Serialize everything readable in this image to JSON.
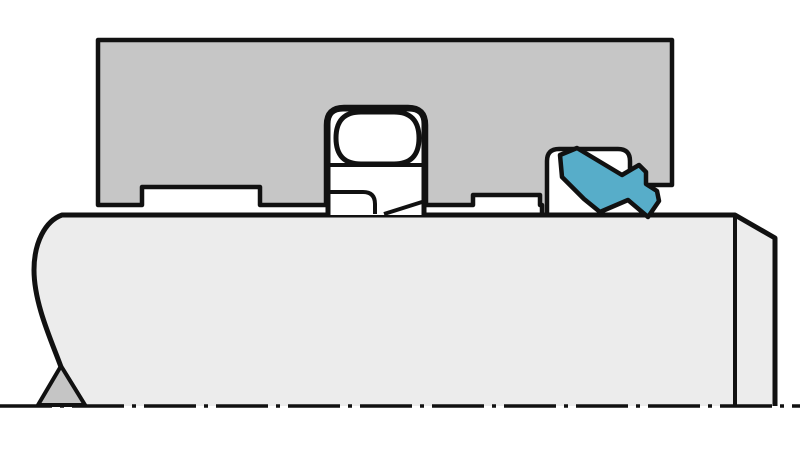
{
  "diagram": {
    "kind": "sectional technical drawing",
    "subject": "rotary shaft sealing arrangement with deep-groove ball bearing and elastomer seal",
    "text_labels": []
  },
  "colors": {
    "background": "#ffffff",
    "housing": "#c6c6c6",
    "shaft": "#ececec",
    "break_cone": "#c5c5c5",
    "seal": "#57adc9",
    "white": "#ffffff",
    "outline": "#111111",
    "none": "none"
  },
  "paths": {
    "housing": "M98,40 L672,40 L672,185 L630,185 L630,161 Q630,149 618,149 L559,149 Q547,149 547,161 L547,215 L542,215 L542,205 L540,205 L540,195 L473,195 L473,205 L426,205 L426,125 Q426,107 408,107 L344,107 Q326,107 326,125 L326,205 L260,205 L260,187 L142,187 L142,205 L98,205 Z",
    "shaft_fill": "M62,215 L735,215 L775,238 L775,406 L85,406 L61,367 C52,342 34,304 34,270 C34,243 45,221 62,215 Z",
    "shaft_stroke": "M85,406 L61,367 C52,342 34,304 34,270 C34,243 45,221 62,215 L735,215 L775,238 L775,406",
    "shaft_step_line": "M735,217 L735,405",
    "break_cone": "M61,366 L38,405 L85,405 Z",
    "bearing_outer": "M328,215 L328,124 Q328,109 343,109 L409,109 Q424,109 424,124 L424,215",
    "bearing_ball": "M361,112 L394,112 Q419,112 419,138 Q419,164 394,164 L361,164 Q336,164 336,138 Q336,112 361,112 Z",
    "bearing_divider": "M330,165 L422,165",
    "bearing_inner_step": "M330,192 L363,192 Q375,192 375,204 L375,214",
    "bearing_inner_chamfer": "M384,214 L422,202",
    "seal": "M560,155 L577,148 L622,175 L639,165 L646,172 L646,184 L657,191 L659,201 L648,217 L628,200 L600,212 L584,199 L562,177 Z",
    "centerline": "M0,406 L800,406"
  }
}
